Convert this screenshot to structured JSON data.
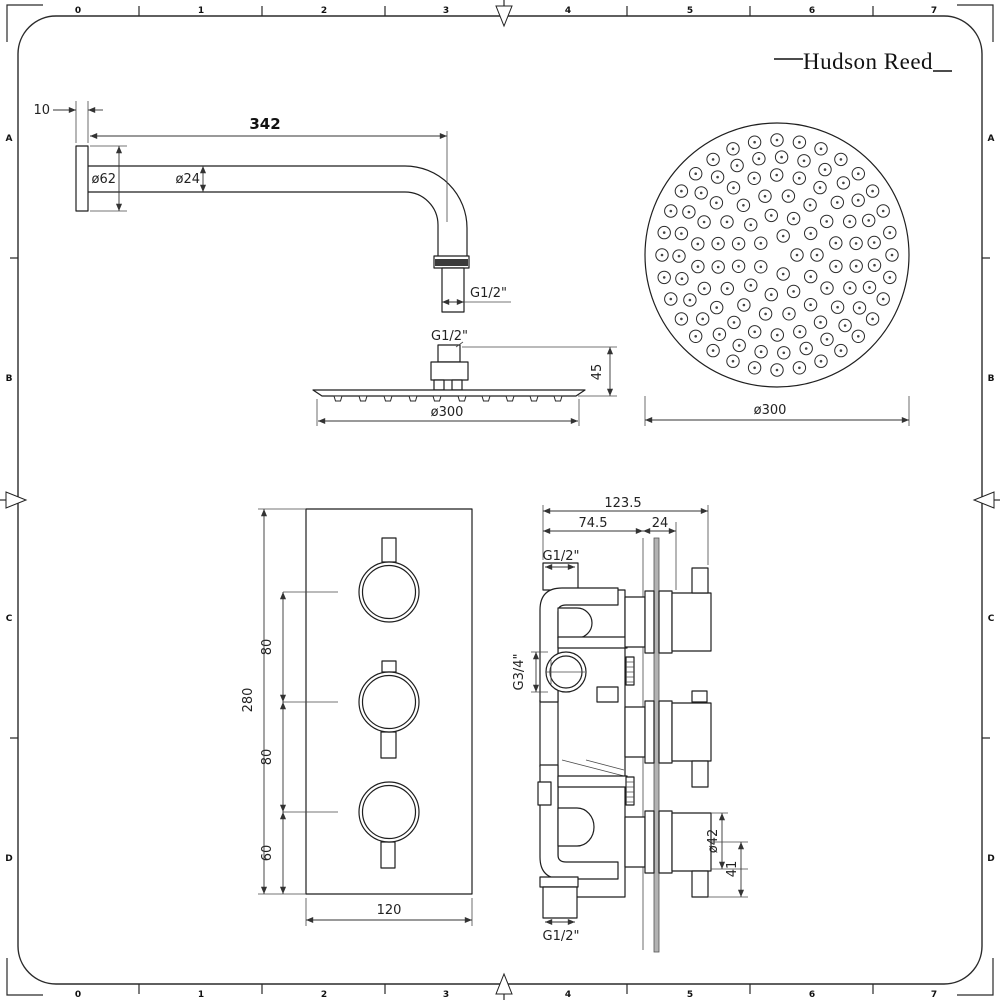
{
  "frame": {
    "columns": [
      "0",
      "1",
      "2",
      "3",
      "4",
      "5",
      "6",
      "7"
    ],
    "rows": [
      "A",
      "B",
      "C",
      "D"
    ]
  },
  "brand": {
    "name": "Hudson Reed"
  },
  "shower_arm": {
    "wall_plate_thickness": "10",
    "arm_length": "342",
    "flange_diameter": "ø62",
    "arm_diameter": "ø24",
    "outlet_thread": "G1/2\""
  },
  "shower_head_side": {
    "inlet_thread": "G1/2\"",
    "head_height": "45",
    "head_diameter": "ø300"
  },
  "shower_head_face": {
    "head_diameter": "ø300"
  },
  "valve_front": {
    "plate_height": "280",
    "upper_spacing": "80",
    "lower_spacing": "80",
    "bottom_offset": "60",
    "plate_width": "120"
  },
  "valve_side": {
    "overall_depth": "123.5",
    "body_depth": "74.5",
    "plate_to_handle": "24",
    "top_inlet_thread": "G1/2\"",
    "side_inlet_thread": "G3/4\"",
    "bottom_inlet_thread": "G1/2\"",
    "handle_diameter": "ø42",
    "handle_length": "41"
  }
}
